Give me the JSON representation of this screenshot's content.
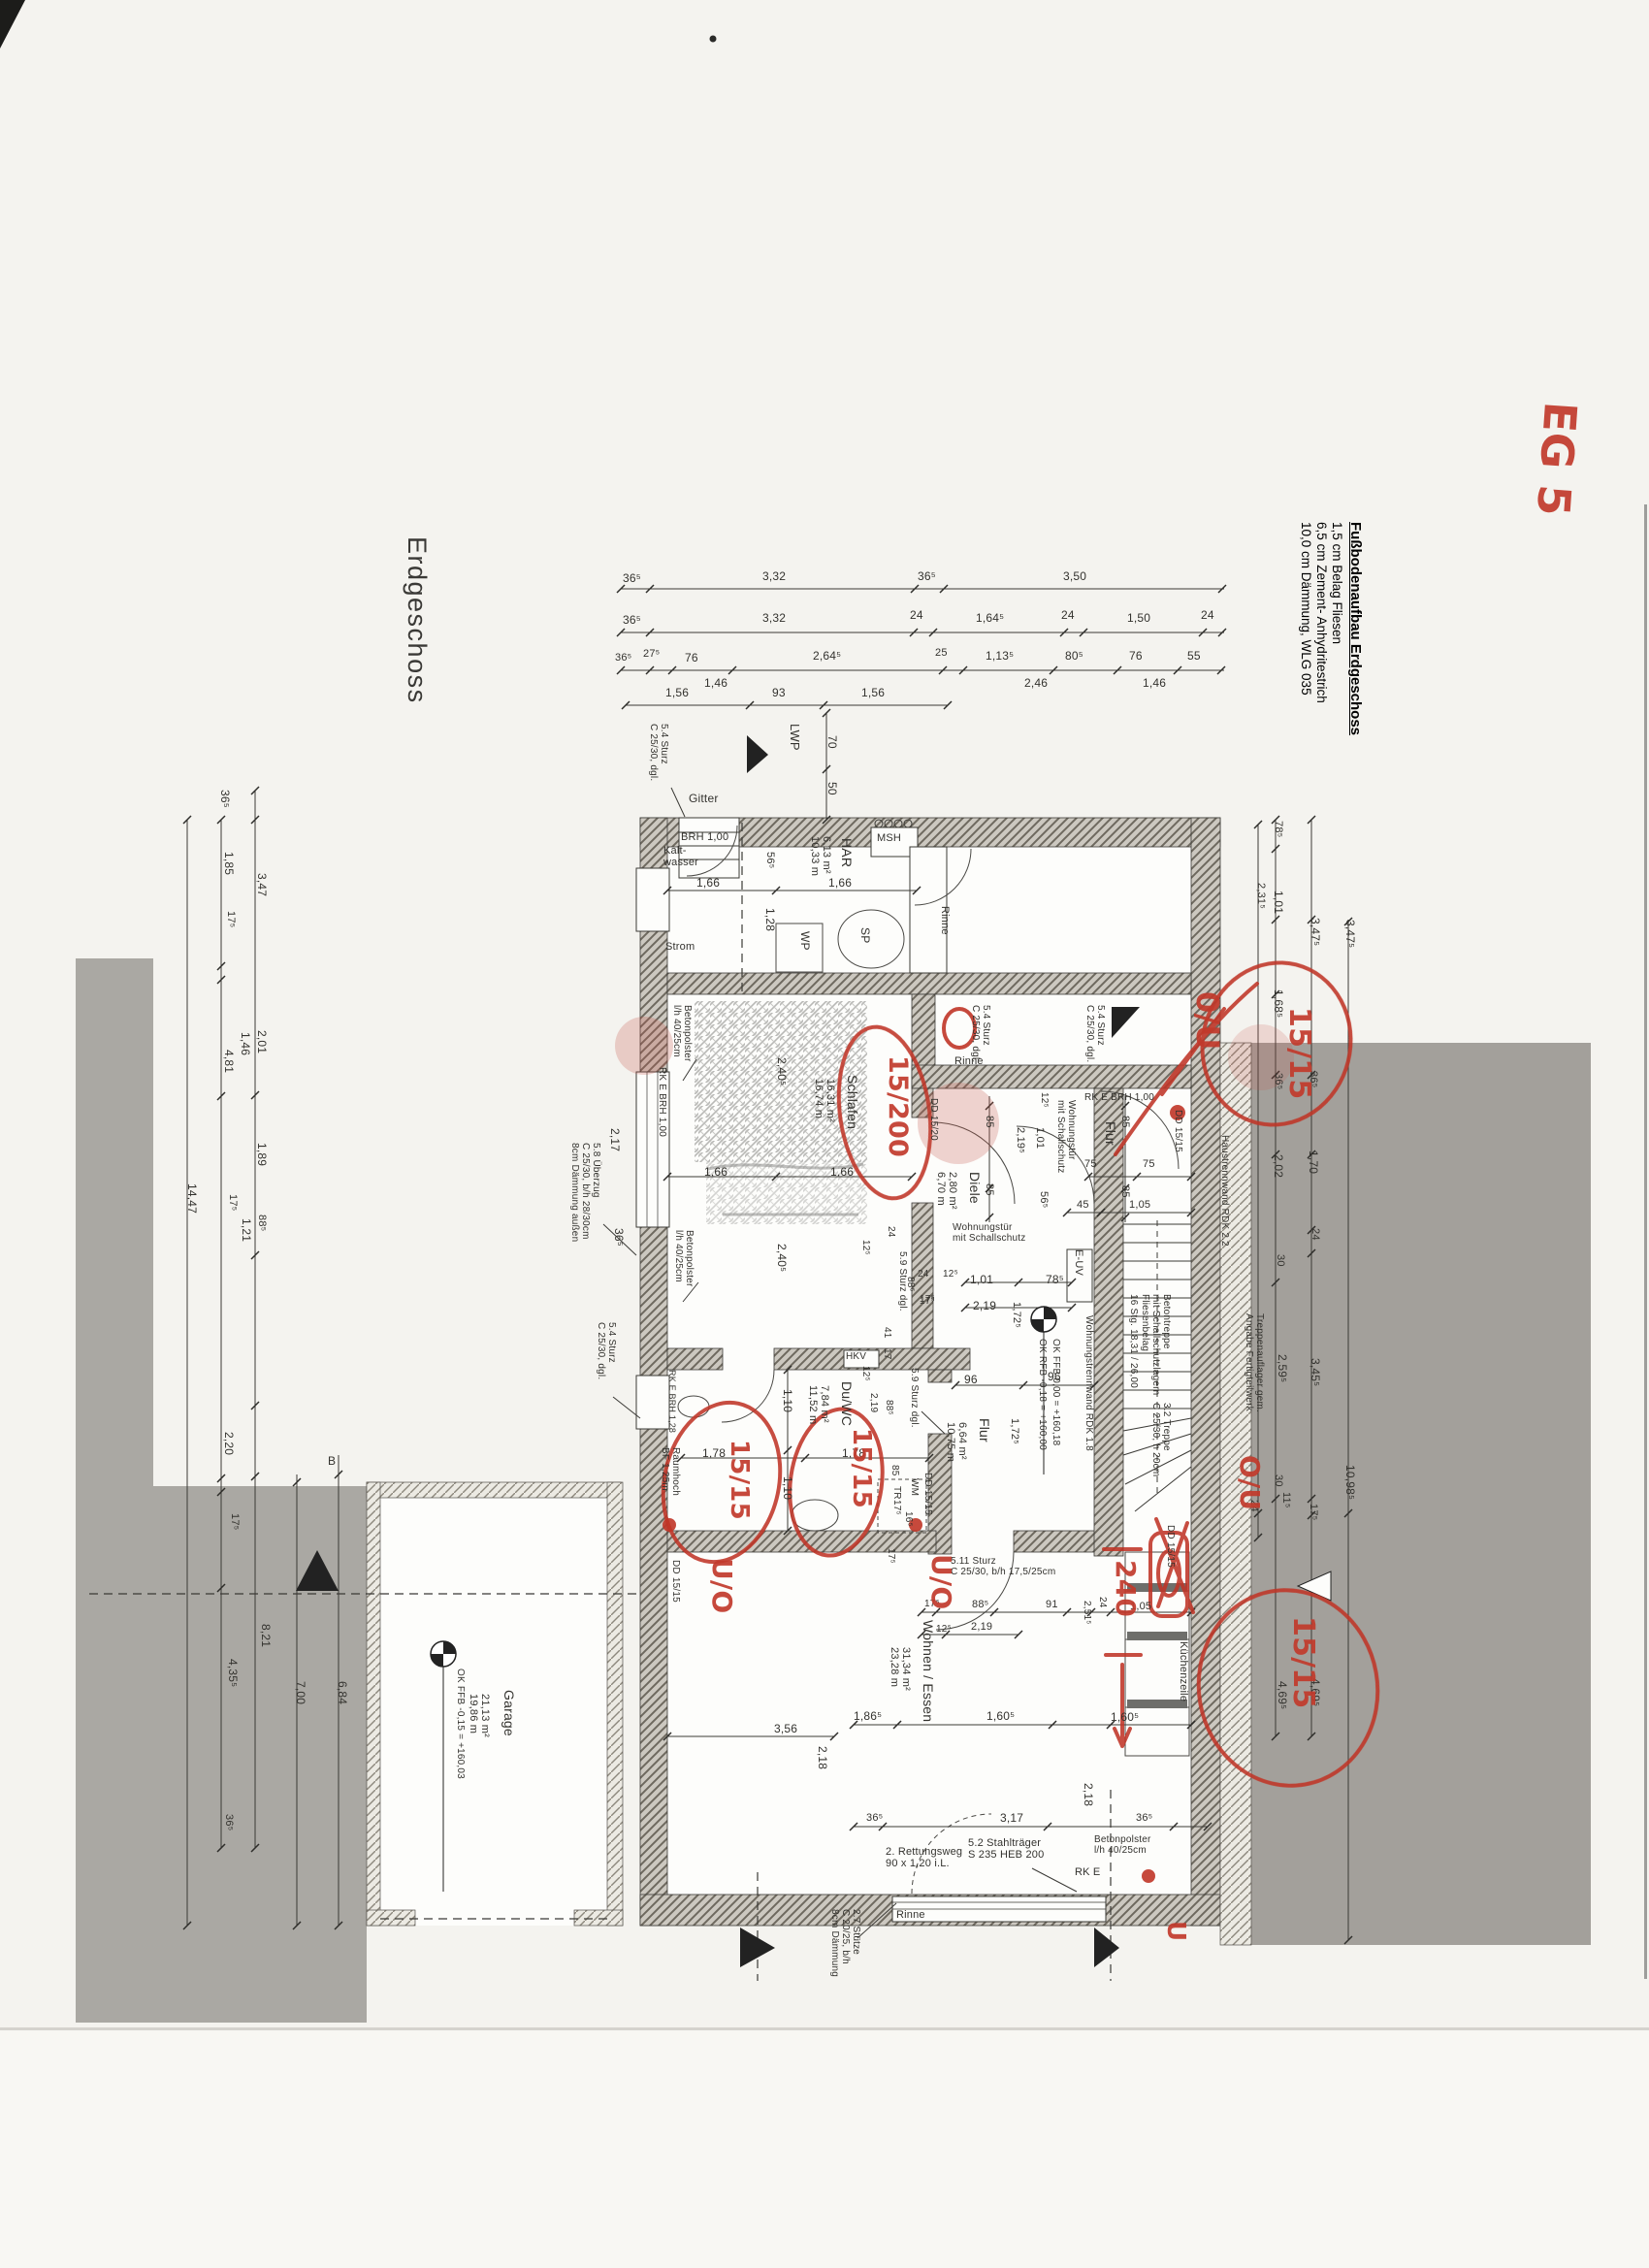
{
  "titles": {
    "plan_title": "Erdgeschoss",
    "sheet_mark": "EG 5"
  },
  "floor_buildup": {
    "heading": "Fußbodenaufbau Erdgeschoss",
    "items": [
      "1,5 cm  Belag Fliesen",
      "6,5 cm  Zement- Anhydritestrich",
      "10,0 cm Dämmung, WLG 035"
    ]
  },
  "colors": {
    "annotation_red": "#c23a2c",
    "print_black": "#33322e",
    "neighbor_gray": "#a3a09b",
    "paper": "#f4f3ef"
  },
  "print_labels": [
    [
      "36⁵",
      642,
      590,
      0,
      12
    ],
    [
      "3,32",
      786,
      588,
      0,
      12
    ],
    [
      "36⁵",
      946,
      588,
      0,
      12
    ],
    [
      "3,50",
      1096,
      588,
      0,
      12
    ],
    [
      "36⁵",
      642,
      633,
      0,
      12
    ],
    [
      "3,32",
      786,
      631,
      0,
      12
    ],
    [
      "24",
      938,
      628,
      0,
      12
    ],
    [
      "1,64⁵",
      1006,
      631,
      0,
      12
    ],
    [
      "24",
      1094,
      628,
      0,
      12
    ],
    [
      "1,50",
      1162,
      631,
      0,
      12
    ],
    [
      "24",
      1238,
      628,
      0,
      12
    ],
    [
      "36⁵",
      634,
      672,
      0,
      11
    ],
    [
      "27⁵",
      663,
      668,
      0,
      11
    ],
    [
      "76",
      706,
      672,
      0,
      12
    ],
    [
      "2,64⁵",
      838,
      670,
      0,
      12
    ],
    [
      "25",
      964,
      667,
      0,
      11
    ],
    [
      "1,13⁵",
      1016,
      670,
      0,
      12
    ],
    [
      "80⁵",
      1098,
      670,
      0,
      12
    ],
    [
      "76",
      1164,
      670,
      0,
      12
    ],
    [
      "55",
      1224,
      670,
      0,
      12
    ],
    [
      "1,46",
      726,
      698,
      0,
      12
    ],
    [
      "2,46",
      1056,
      698,
      0,
      12
    ],
    [
      "1,46",
      1178,
      698,
      0,
      12
    ],
    [
      "1,56",
      686,
      708,
      0,
      12
    ],
    [
      "93",
      796,
      708,
      0,
      12
    ],
    [
      "1,56",
      888,
      708,
      0,
      12
    ],
    [
      "LWP",
      826,
      746,
      1,
      13,
      "room-label-lwp"
    ],
    [
      "70",
      864,
      758,
      1,
      12
    ],
    [
      "50",
      864,
      806,
      1,
      12
    ],
    [
      "Gitter",
      710,
      817,
      0,
      12,
      "note-label-gitter"
    ],
    [
      "5.4  Sturz\nC 25/30, dgl.",
      690,
      746,
      1,
      10,
      "ref-callout"
    ],
    [
      "BRH 1,00",
      702,
      857,
      0,
      11
    ],
    [
      "Kalt-\nwasser",
      684,
      871,
      0,
      11,
      "note-label-kaltwasser"
    ],
    [
      "HAR",
      880,
      864,
      1,
      14,
      "room-label-har"
    ],
    [
      "6,13 m²\n10,33 m",
      858,
      862,
      1,
      11
    ],
    [
      "MSH",
      904,
      858,
      0,
      11,
      "note-label-msh"
    ],
    [
      "56⁵",
      800,
      878,
      1,
      11
    ],
    [
      "1,66",
      718,
      904,
      0,
      12
    ],
    [
      "1,66",
      854,
      904,
      0,
      12
    ],
    [
      "1,28",
      800,
      936,
      1,
      12
    ],
    [
      "WP",
      836,
      960,
      1,
      12,
      "note-label-wp"
    ],
    [
      "SP",
      898,
      956,
      1,
      12,
      "note-label-sp"
    ],
    [
      "Strom",
      686,
      970,
      0,
      11,
      "note-label-strom"
    ],
    [
      "Rinne",
      980,
      934,
      1,
      11,
      "note-label-rinne"
    ],
    [
      "5.4  Sturz\nC 25/30, dgl.",
      1022,
      1036,
      1,
      10,
      "ref-callout"
    ],
    [
      "5.4  Sturz\nC 25/30, dgl.",
      1140,
      1036,
      1,
      10,
      "ref-callout"
    ],
    [
      "Rinne",
      984,
      1088,
      0,
      11,
      "note-label-rinne"
    ],
    [
      "5.8  Überzug\nC 25/30, b/h 28/30cm\n8cm Dämmung außen",
      620,
      1178,
      1,
      10,
      "ref-callout"
    ],
    [
      "Betonpolster\nl/h 40/25cm",
      714,
      1036,
      1,
      10,
      "note-label-betonpolster"
    ],
    [
      "RK E   BRH 1,00",
      688,
      1100,
      1,
      10
    ],
    [
      "2,17",
      640,
      1163,
      1,
      12
    ],
    [
      "36⁵",
      644,
      1266,
      1,
      12
    ],
    [
      "Betonpolster\nl/h 40/25cm",
      716,
      1268,
      1,
      10,
      "note-label-betonpolster"
    ],
    [
      "5.4  Sturz\nC 25/30, dgl.",
      636,
      1363,
      1,
      10,
      "ref-callout"
    ],
    [
      "Schlafen",
      886,
      1108,
      1,
      14,
      "room-label-schlafen"
    ],
    [
      "16,31 m²\n16,74 m",
      862,
      1112,
      1,
      11
    ],
    [
      "2,40⁵",
      812,
      1090,
      1,
      12
    ],
    [
      "1,66",
      726,
      1202,
      0,
      12
    ],
    [
      "1,66",
      856,
      1202,
      0,
      12
    ],
    [
      "2,40⁵",
      812,
      1282,
      1,
      12
    ],
    [
      "DD 15/20",
      968,
      1132,
      1,
      10
    ],
    [
      "24",
      924,
      1264,
      1,
      10
    ],
    [
      "12⁵",
      898,
      1278,
      1,
      10
    ],
    [
      "88⁵",
      944,
      1316,
      1,
      10
    ],
    [
      "17⁵",
      948,
      1336,
      0,
      10
    ],
    [
      "5.9  Sturz dgl.",
      936,
      1290,
      1,
      10,
      "ref-callout"
    ],
    [
      "RK E  BRH 1,00",
      1118,
      1126,
      0,
      10
    ],
    [
      "DD 15/15",
      1220,
      1144,
      1,
      10
    ],
    [
      "Flur",
      1152,
      1156,
      1,
      14,
      "room-label-flur-oben"
    ],
    [
      "85",
      1026,
      1150,
      1,
      11
    ],
    [
      "85",
      1166,
      1150,
      1,
      11
    ],
    [
      "12⁵",
      1082,
      1126,
      1,
      10
    ],
    [
      "2,19⁵",
      1058,
      1162,
      1,
      11
    ],
    [
      "1,01",
      1078,
      1162,
      1,
      11
    ],
    [
      "Wohnungstür\nmit Schallschutz",
      1110,
      1134,
      1,
      10,
      "note-label-wohnungstuer"
    ],
    [
      "Diele",
      1012,
      1208,
      1,
      14,
      "room-label-diele"
    ],
    [
      "2,80 m²\n6,70 m",
      988,
      1208,
      1,
      11
    ],
    [
      "85",
      1026,
      1220,
      1,
      11
    ],
    [
      "85",
      1166,
      1222,
      1,
      11
    ],
    [
      "75",
      1118,
      1194,
      0,
      11
    ],
    [
      "75",
      1178,
      1194,
      0,
      11
    ],
    [
      "56⁵",
      1082,
      1228,
      1,
      11
    ],
    [
      "45",
      1110,
      1236,
      0,
      11
    ],
    [
      "1,05",
      1164,
      1236,
      0,
      11
    ],
    [
      "Wohnungstür\nmit Schallschutz",
      982,
      1260,
      0,
      10,
      "note-label-wohnungstuer"
    ],
    [
      "E-UV",
      1118,
      1288,
      1,
      11,
      "note-label-euv"
    ],
    [
      "24",
      946,
      1308,
      0,
      10
    ],
    [
      "12⁵",
      972,
      1308,
      0,
      10
    ],
    [
      "17⁵",
      948,
      1334,
      0,
      10
    ],
    [
      "1,01",
      1000,
      1313,
      0,
      12
    ],
    [
      "2,19",
      1003,
      1340,
      0,
      12
    ],
    [
      "1,72⁵",
      1054,
      1342,
      1,
      11
    ],
    [
      "78⁵",
      1078,
      1313,
      0,
      12
    ],
    [
      "OK FFB 0,00 = +160,18",
      1094,
      1380,
      1,
      10,
      "note-label-hoehe"
    ],
    [
      "OK RFB -0,18 = +160,00",
      1080,
      1380,
      1,
      10,
      "note-label-hoehe"
    ],
    [
      "Wohnungstrennwand RDK 1.8",
      1128,
      1356,
      1,
      10,
      "note-label-trennwand"
    ],
    [
      "96",
      994,
      1416,
      0,
      12
    ],
    [
      "96",
      1080,
      1413,
      0,
      12
    ],
    [
      "1,72⁵",
      1052,
      1462,
      1,
      11
    ],
    [
      "Flur",
      1022,
      1462,
      1,
      14,
      "room-label-flur-unten"
    ],
    [
      "6,64 m²\n10,75 m",
      998,
      1466,
      1,
      11
    ],
    [
      "Betontreppe\nmit Schallschutzlagern\nFliesenbelag\n16 Stg. 18,31 / 26,00",
      1208,
      1334,
      1,
      10,
      "note-label-treppe"
    ],
    [
      "3.2  Treppe\nC 25/30, h 20cm",
      1208,
      1446,
      1,
      10,
      "ref-callout"
    ],
    [
      "Treppenauflager gem.\nAngabe Fertigteilwerk",
      1304,
      1354,
      1,
      10,
      "note-label-treppenauflager"
    ],
    [
      "Haustrennwand RDK 2.2",
      1268,
      1170,
      1,
      10,
      "note-label-haustrennwand"
    ],
    [
      "HKV",
      872,
      1393,
      0,
      10,
      "note-label-hkv"
    ],
    [
      "41",
      920,
      1368,
      1,
      10
    ],
    [
      "17",
      920,
      1390,
      1,
      10
    ],
    [
      "12⁵",
      898,
      1408,
      1,
      10
    ],
    [
      "2,19",
      906,
      1436,
      1,
      10
    ],
    [
      "88⁵",
      922,
      1443,
      1,
      10
    ],
    [
      "5.9  Sturz dgl.",
      948,
      1410,
      1,
      10,
      "ref-callout"
    ],
    [
      "Du/WC",
      880,
      1424,
      1,
      14,
      "room-label-duwc"
    ],
    [
      "7,84 m²\n11,52 m",
      856,
      1428,
      1,
      11
    ],
    [
      "1,10",
      818,
      1432,
      1,
      12
    ],
    [
      "1,78",
      724,
      1492,
      0,
      12
    ],
    [
      "1,78",
      868,
      1492,
      0,
      12
    ],
    [
      "1,10",
      818,
      1522,
      1,
      12
    ],
    [
      "85",
      928,
      1510,
      1,
      10
    ],
    [
      "WM",
      948,
      1524,
      1,
      10,
      "note-label-wm"
    ],
    [
      "TR",
      930,
      1532,
      1,
      10,
      "note-label-tr"
    ],
    [
      "17⁵",
      930,
      1546,
      1,
      10
    ],
    [
      "16⁵",
      942,
      1558,
      1,
      10
    ],
    [
      "DD 15/15",
      962,
      1518,
      1,
      10
    ],
    [
      "Raumhoch\nBF 1,25m",
      702,
      1492,
      1,
      10
    ],
    [
      "RK E  BRH 1,28",
      698,
      1412,
      1,
      9
    ],
    [
      "DD 15/15",
      702,
      1608,
      1,
      10
    ],
    [
      "17⁵",
      924,
      1596,
      1,
      10
    ],
    [
      "3,56",
      798,
      1776,
      0,
      12
    ],
    [
      "2,18",
      854,
      1800,
      1,
      12
    ],
    [
      "5.11  Sturz\nC 25/30, b/h 17,5/25cm",
      980,
      1604,
      0,
      10,
      "ref-callout"
    ],
    [
      "17⁵",
      953,
      1648,
      0,
      10
    ],
    [
      "88⁵",
      1002,
      1648,
      0,
      11
    ],
    [
      "91",
      1078,
      1648,
      0,
      11
    ],
    [
      "12⁵",
      965,
      1674,
      0,
      10
    ],
    [
      "2,19",
      1001,
      1671,
      0,
      11
    ],
    [
      "2,51⁵",
      1126,
      1650,
      1,
      10
    ],
    [
      "24",
      1142,
      1646,
      1,
      10
    ],
    [
      "1,05",
      1165,
      1650,
      0,
      11
    ],
    [
      "Wohnen / Essen",
      964,
      1670,
      1,
      14,
      "room-label-wohnen-essen"
    ],
    [
      "31,34 m²\n23,28 m",
      940,
      1698,
      1,
      11
    ],
    [
      "1,86⁵",
      880,
      1763,
      0,
      12
    ],
    [
      "1,60⁵",
      1017,
      1763,
      0,
      12
    ],
    [
      "1,60⁵",
      1145,
      1764,
      0,
      12
    ],
    [
      "2,18",
      1128,
      1838,
      1,
      12
    ],
    [
      "Küchenzeile",
      1226,
      1692,
      1,
      11,
      "note-label-kuechenzeile"
    ],
    [
      "DD 15/15",
      1212,
      1572,
      1,
      10
    ],
    [
      "36⁵",
      893,
      1868,
      0,
      11
    ],
    [
      "3,17",
      1031,
      1868,
      0,
      12
    ],
    [
      "36⁵",
      1171,
      1868,
      0,
      11
    ],
    [
      "2. Rettungsweg\n90 x 1,20 i.L.",
      913,
      1903,
      0,
      11,
      "note-label-rettungsweg"
    ],
    [
      "5.2  Stahlträger\nS 235 HEB 200",
      998,
      1894,
      0,
      11,
      "ref-callout"
    ],
    [
      "Betonpolster\nl/h 40/25cm",
      1128,
      1891,
      0,
      10,
      "note-label-betonpolster"
    ],
    [
      "RK E",
      1108,
      1924,
      0,
      11
    ],
    [
      "Rinne",
      924,
      1968,
      0,
      11,
      "note-label-rinne"
    ],
    [
      "2.7  Stütze\nC 20/25, b/h\n8cm Dämmung",
      888,
      1968,
      1,
      10,
      "ref-callout"
    ],
    [
      "Garage",
      532,
      1742,
      1,
      14,
      "room-label-garage"
    ],
    [
      "21,13 m²\n19,86 m",
      506,
      1746,
      1,
      11
    ],
    [
      "OK FFB -0,15 = +160,03",
      480,
      1720,
      1,
      10,
      "note-label-hoehe"
    ],
    [
      "B",
      338,
      1500,
      0,
      12,
      "note-label-schnitt-b"
    ],
    [
      "36⁵",
      238,
      814,
      1,
      12
    ],
    [
      "1,85",
      242,
      878,
      1,
      12
    ],
    [
      "3,47",
      276,
      900,
      1,
      12
    ],
    [
      "17⁵",
      244,
      939,
      1,
      11
    ],
    [
      "1,46",
      259,
      1064,
      1,
      12
    ],
    [
      "2,01",
      276,
      1062,
      1,
      12
    ],
    [
      "4,81",
      242,
      1082,
      1,
      12
    ],
    [
      "1,89",
      276,
      1178,
      1,
      12
    ],
    [
      "14,47",
      204,
      1220,
      1,
      12
    ],
    [
      "17⁵",
      246,
      1231,
      1,
      11
    ],
    [
      "88⁵",
      276,
      1252,
      1,
      11
    ],
    [
      "1,21",
      260,
      1256,
      1,
      12
    ],
    [
      "2,20",
      242,
      1476,
      1,
      12
    ],
    [
      "17⁵",
      248,
      1560,
      1,
      11
    ],
    [
      "8,21",
      280,
      1674,
      1,
      12
    ],
    [
      "4,35⁵",
      246,
      1710,
      1,
      12
    ],
    [
      "36⁵",
      242,
      1870,
      1,
      11
    ],
    [
      "7,00",
      316,
      1733,
      1,
      12
    ],
    [
      "6,84",
      359,
      1733,
      1,
      12
    ],
    [
      "78⁵",
      1324,
      846,
      1,
      11
    ],
    [
      "2,31⁵",
      1306,
      910,
      1,
      11
    ],
    [
      "1,01",
      1324,
      918,
      1,
      12
    ],
    [
      "3,47⁵",
      1362,
      946,
      1,
      12
    ],
    [
      "3,47⁵",
      1398,
      948,
      1,
      12
    ],
    [
      "1,68⁵",
      1324,
      1020,
      1,
      12
    ],
    [
      "36⁵",
      1324,
      1106,
      1,
      11
    ],
    [
      "36⁵",
      1360,
      1104,
      1,
      11
    ],
    [
      "1,70",
      1360,
      1186,
      1,
      12
    ],
    [
      "2,02",
      1324,
      1190,
      1,
      12
    ],
    [
      "24",
      1362,
      1266,
      1,
      11
    ],
    [
      "30",
      1326,
      1293,
      1,
      11
    ],
    [
      "2,59⁵",
      1328,
      1396,
      1,
      12
    ],
    [
      "3,45⁵",
      1362,
      1400,
      1,
      12
    ],
    [
      "30",
      1324,
      1520,
      1,
      11
    ],
    [
      "11⁵",
      1332,
      1538,
      1,
      11
    ],
    [
      "24",
      1299,
      1546,
      1,
      11
    ],
    [
      "17⁵",
      1360,
      1550,
      1,
      11
    ],
    [
      "10,98⁵",
      1398,
      1510,
      1,
      12
    ],
    [
      "4,69⁵",
      1328,
      1733,
      1,
      12
    ],
    [
      "4,69⁵",
      1362,
      1730,
      1,
      12
    ]
  ],
  "red_annotations": [
    [
      "15/200",
      940,
      1088,
      1,
      27,
      "red-note-15-200"
    ],
    [
      "0/U",
      1262,
      1022,
      1,
      32,
      "red-note-o-u"
    ],
    [
      "15/15",
      1356,
      1038,
      1,
      30,
      "red-note-15-15"
    ],
    [
      "15/15",
      776,
      1484,
      1,
      26,
      "red-note-15-15"
    ],
    [
      "15/15",
      902,
      1472,
      1,
      26,
      "red-note-15-15"
    ],
    [
      "U/O",
      760,
      1606,
      1,
      28,
      "red-note-u-o"
    ],
    [
      "U/O",
      986,
      1602,
      1,
      28,
      "red-note-u-o"
    ],
    [
      "O/U",
      1304,
      1500,
      1,
      28,
      "red-note-o-u"
    ],
    [
      "15/15",
      1360,
      1666,
      1,
      30,
      "red-note-15-15"
    ],
    [
      "240",
      1176,
      1608,
      1,
      28,
      "red-note-240"
    ],
    [
      "U",
      1226,
      1980,
      1,
      26,
      "red-note-u"
    ]
  ]
}
